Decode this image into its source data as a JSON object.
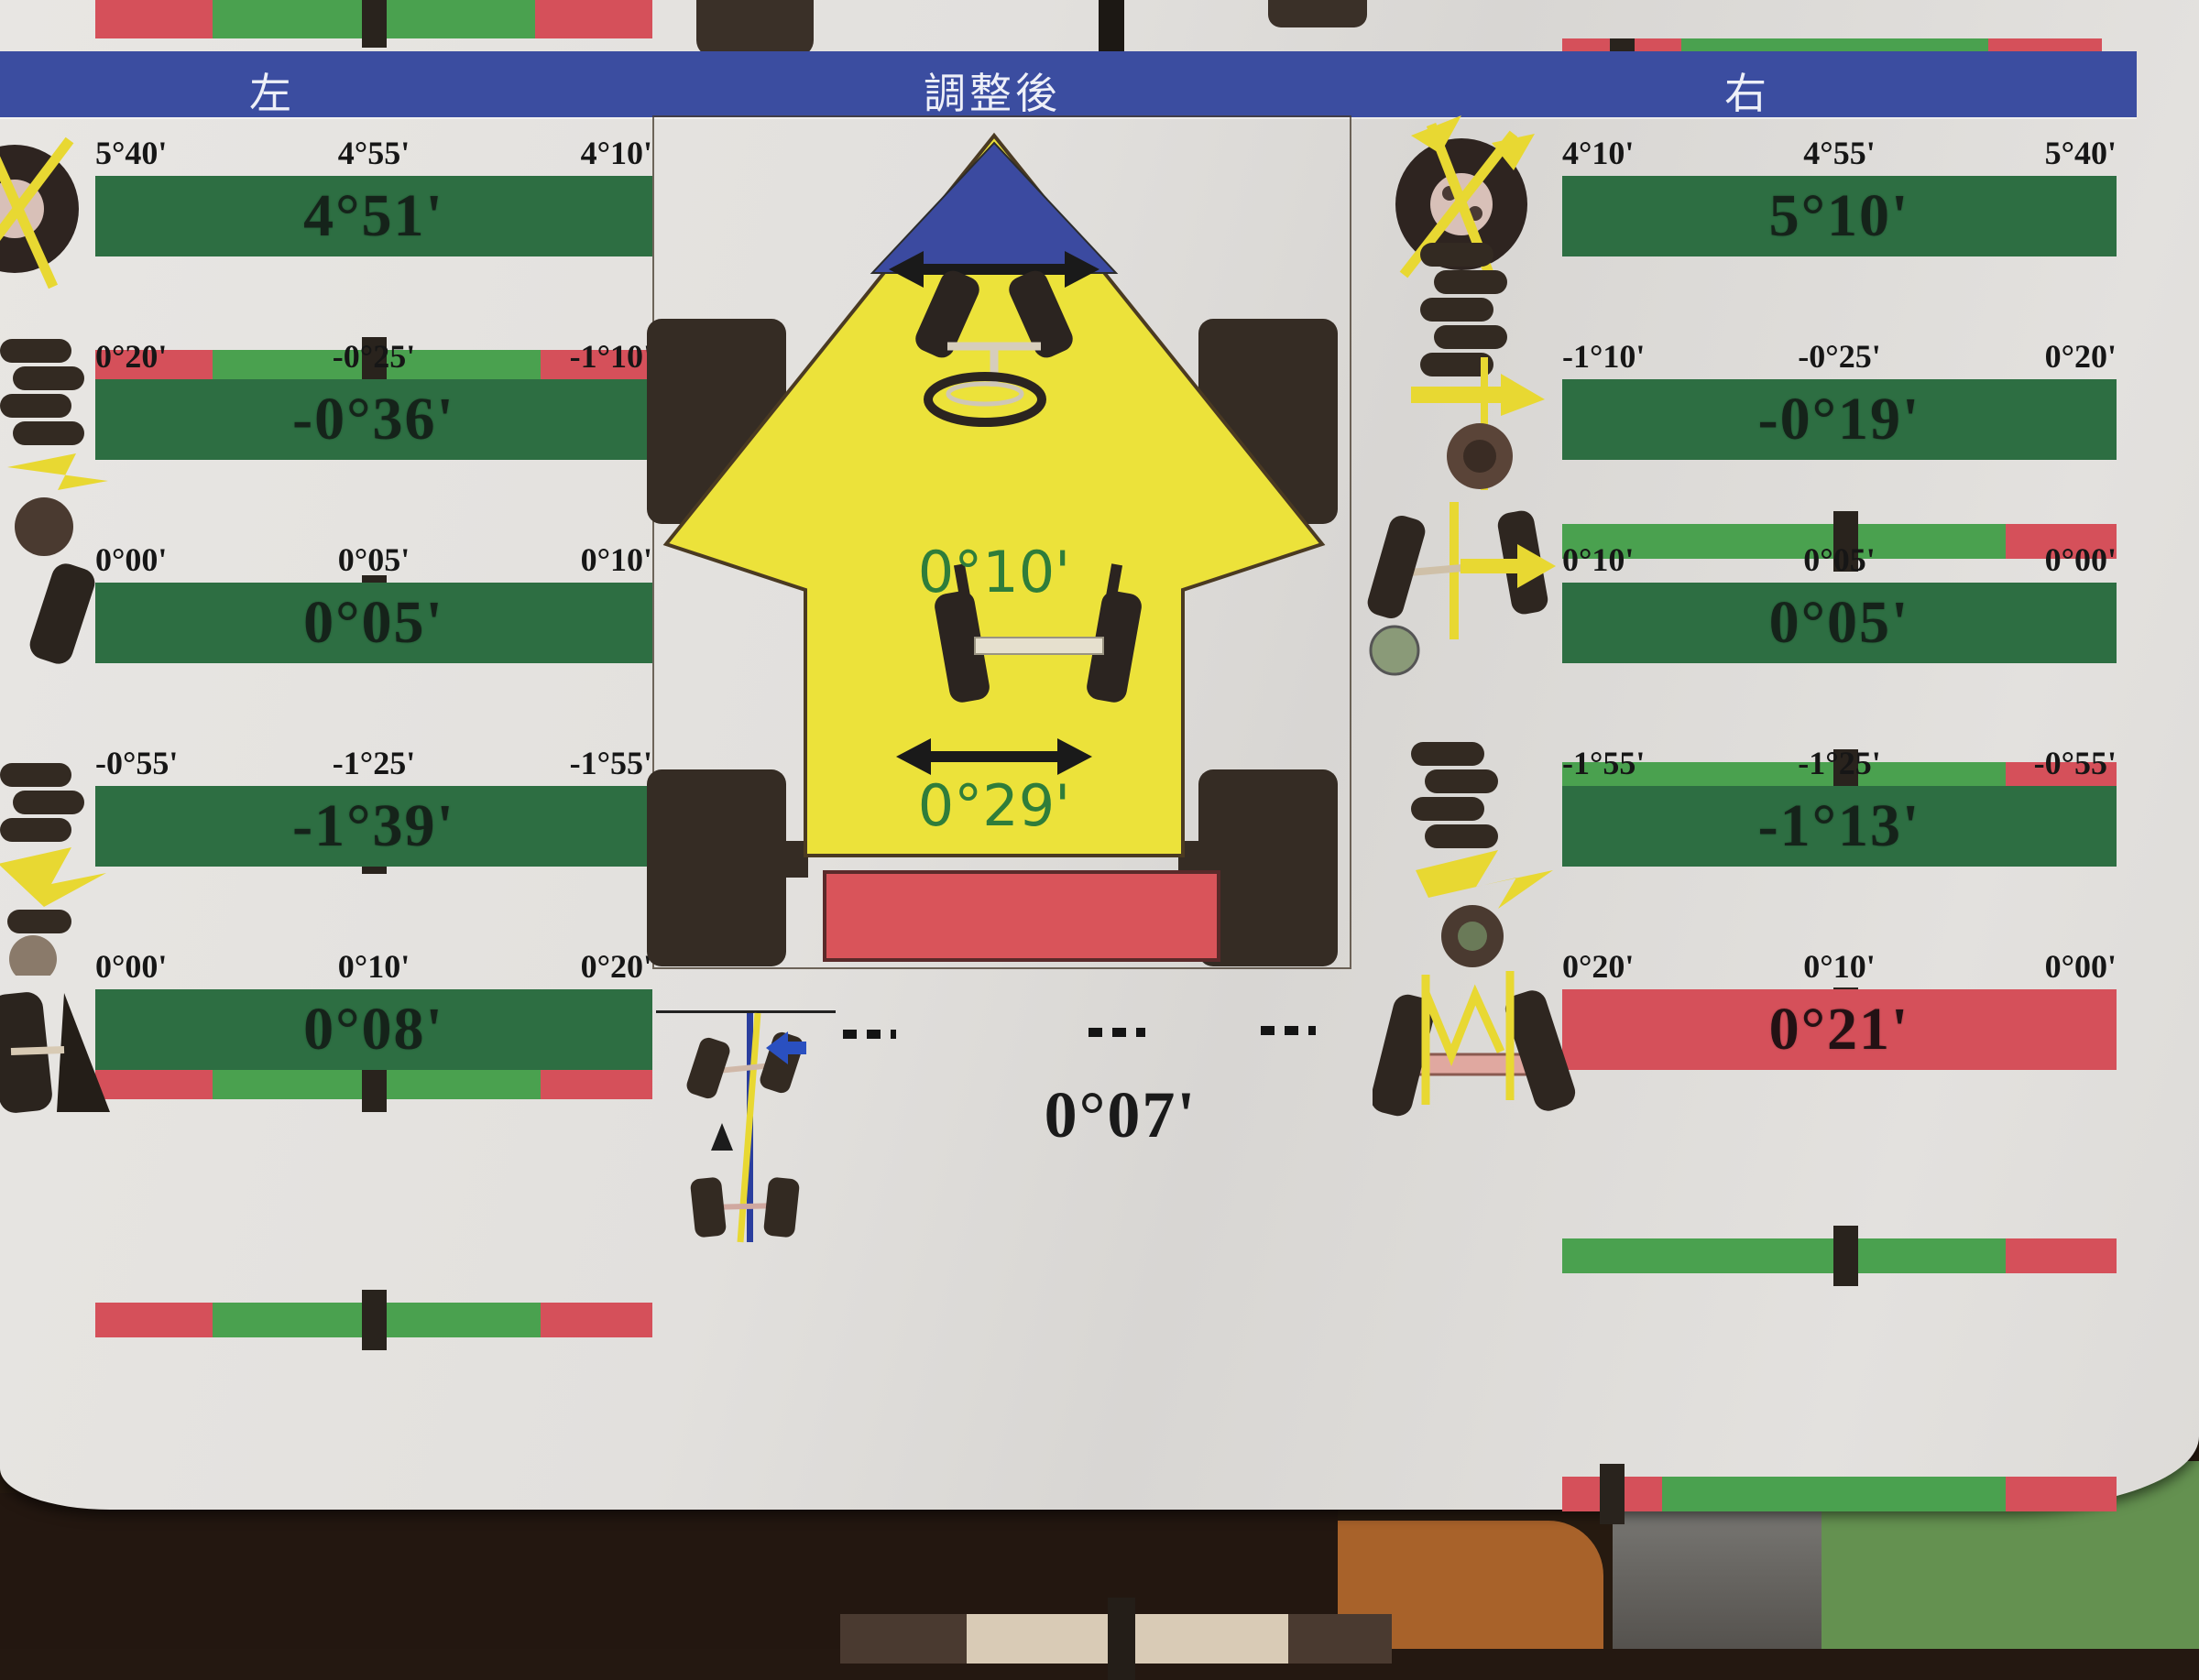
{
  "header": {
    "left_label": "左",
    "center_label": "調整後",
    "right_label": "右"
  },
  "center": {
    "front_toe_value": "0°10'",
    "rear_toe_value": "0°29'",
    "thrust_value": "0°07'"
  },
  "left_column": {
    "rows": [
      {
        "label": "left-front-camber",
        "ticks": [
          "5°40'",
          "4°55'",
          "4°10'"
        ],
        "value": "4°51'",
        "status": "ok",
        "meter": {
          "segments": [
            [
              "red",
              21
            ],
            [
              "green",
              59
            ],
            [
              "red",
              20
            ]
          ],
          "marker": 50
        }
      },
      {
        "label": "left-front-caster",
        "ticks": [
          "0°20'",
          "-0°25'",
          "-1°10'"
        ],
        "value": "-0°36'",
        "status": "ok",
        "meter": {
          "segments": [
            [
              "red",
              21
            ],
            [
              "green",
              59
            ],
            [
              "red",
              20
            ]
          ],
          "marker": 50
        }
      },
      {
        "label": "left-front-toe",
        "ticks": [
          "0°00'",
          "0°05'",
          "0°10'"
        ],
        "value": "0°05'",
        "status": "ok",
        "meter": {
          "segments": [
            [
              "red",
              21
            ],
            [
              "green",
              59
            ],
            [
              "red",
              20
            ]
          ],
          "marker": 50
        }
      },
      {
        "label": "left-rear-camber",
        "ticks": [
          "-0°55'",
          "-1°25'",
          "-1°55'"
        ],
        "value": "-1°39'",
        "status": "ok",
        "meter": {
          "segments": [
            [
              "red",
              21
            ],
            [
              "green",
              59
            ],
            [
              "red",
              20
            ]
          ],
          "marker": 50
        }
      },
      {
        "label": "left-rear-toe",
        "ticks": [
          "0°00'",
          "0°10'",
          "0°20'"
        ],
        "value": "0°08'",
        "status": "ok",
        "meter": {
          "segments": [
            [
              "red",
              21
            ],
            [
              "green",
              59
            ],
            [
              "red",
              20
            ]
          ],
          "marker": 50
        }
      }
    ]
  },
  "right_column": {
    "rows": [
      {
        "label": "right-front-camber",
        "ticks": [
          "4°10'",
          "4°55'",
          "5°40'"
        ],
        "value": "5°10'",
        "status": "ok",
        "meter": {
          "segments": [
            [
              "green",
              80
            ],
            [
              "red",
              20
            ]
          ],
          "marker": 51
        }
      },
      {
        "label": "right-front-caster",
        "ticks": [
          "-1°10'",
          "-0°25'",
          "0°20'"
        ],
        "value": "-0°19'",
        "status": "ok",
        "meter": {
          "segments": [
            [
              "green",
              80
            ],
            [
              "red",
              20
            ]
          ],
          "marker": 51
        }
      },
      {
        "label": "right-front-toe",
        "ticks": [
          "0°10'",
          "0°05'",
          "0°00'"
        ],
        "value": "0°05'",
        "status": "ok",
        "meter": {
          "segments": [
            [
              "green",
              80
            ],
            [
              "red",
              20
            ]
          ],
          "marker": 51
        }
      },
      {
        "label": "right-rear-camber",
        "ticks": [
          "-1°55'",
          "-1°25'",
          "-0°55'"
        ],
        "value": "-1°13'",
        "status": "ok",
        "meter": {
          "segments": [
            [
              "green",
              80
            ],
            [
              "red",
              20
            ]
          ],
          "marker": 51
        }
      },
      {
        "label": "right-rear-toe",
        "ticks": [
          "0°20'",
          "0°10'",
          "0°00'"
        ],
        "value": "0°21'",
        "status": "out",
        "meter": {
          "segments": [
            [
              "red",
              18
            ],
            [
              "green",
              62
            ],
            [
              "red",
              20
            ]
          ],
          "marker": 9
        }
      }
    ]
  },
  "top_strip": {
    "left_meter": {
      "segments": [
        [
          "red",
          21
        ],
        [
          "green",
          58
        ],
        [
          "red",
          21
        ]
      ],
      "marker": 50
    },
    "right_meter": {
      "segments": [
        [
          "red",
          22
        ],
        [
          "green",
          57
        ],
        [
          "red",
          21
        ]
      ],
      "marker": 11
    }
  },
  "colors": {
    "header_blue": "#3b4da0",
    "bar_green_dark": "#2d6e42",
    "bar_green_light": "#4aa14f",
    "bar_red": "#d5505a",
    "marker_black": "#29231d",
    "car_yellow": "#ece23a",
    "windshield_blue": "#3b4aa0",
    "toe_text_green": "#2f7d3a",
    "thrust_tan": "#d9cbb6",
    "thrust_brown": "#4a3a30"
  }
}
